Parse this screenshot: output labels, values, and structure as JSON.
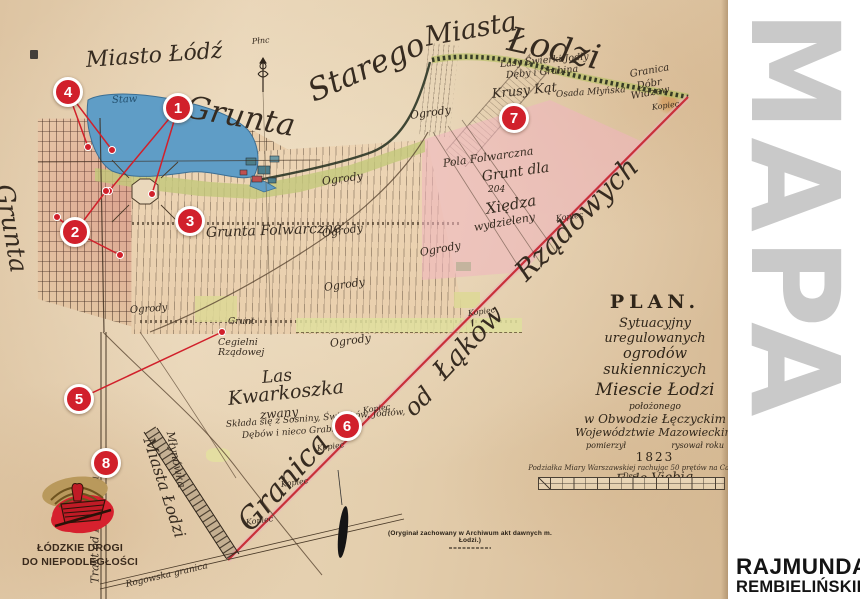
{
  "sidebar": {
    "vertical_title": "MAPA",
    "credit_line1": "RAJMUNDA",
    "credit_line2": "REMBIELIŃSKIEGO"
  },
  "plan_cartouche": {
    "title": "PLAN.",
    "line1": "Sytuacyjny uregulowanych",
    "line2": "ogrodów sukienniczych",
    "line3": "Miescie Łodzi",
    "line4": "położonego",
    "line5": "w Obwodzie Łęczyckim",
    "line6": "Województwie Mazowieckim",
    "measured_label": "pomierzył",
    "drawn_label": "rysował roku",
    "year": "1823",
    "signature": "F. de Viebig"
  },
  "scale": {
    "caption": "Podziałka Miary Warszawskiej rachując 50 prętów na Cal. Dec."
  },
  "source_note": "(Oryginał zachowany w Archiwum akt dawnych m. Łodzi.)",
  "logo": {
    "line1": "ŁÓDZKIE DROGI",
    "line2": "DO NIEPODLEGŁOŚCI"
  },
  "colors": {
    "marker_red": "#d1202b",
    "boundary_red": "#c9303a",
    "water_blue": "#5f9dc6",
    "pink_area": "#f0b5bf",
    "parchment": "#e3cdae",
    "sidebar_gray": "#c9c9c9"
  },
  "markers": [
    {
      "n": "1",
      "x": 178,
      "y": 108,
      "dots": [
        [
          109,
          191
        ],
        [
          152,
          194
        ]
      ]
    },
    {
      "n": "2",
      "x": 75,
      "y": 232,
      "dots": [
        [
          106,
          191
        ],
        [
          57,
          217
        ],
        [
          120,
          255
        ]
      ]
    },
    {
      "n": "3",
      "x": 190,
      "y": 221,
      "dots": []
    },
    {
      "n": "4",
      "x": 68,
      "y": 92,
      "dots": [
        [
          88,
          147
        ],
        [
          112,
          150
        ]
      ]
    },
    {
      "n": "5",
      "x": 79,
      "y": 399,
      "dots": [
        [
          222,
          332
        ]
      ]
    },
    {
      "n": "6",
      "x": 347,
      "y": 426,
      "dots": []
    },
    {
      "n": "7",
      "x": 514,
      "y": 118,
      "dots": []
    },
    {
      "n": "8",
      "x": 106,
      "y": 463,
      "dots": []
    }
  ],
  "labels": [
    {
      "id": "miasto-lodz",
      "t": "Miasto Łódź",
      "x": 86,
      "y": 50,
      "r": -4,
      "s": 22
    },
    {
      "id": "grunta-arc",
      "t": "Grunta",
      "x": 186,
      "y": 92,
      "r": 10,
      "s": 31
    },
    {
      "id": "starego-arc",
      "t": "Starego",
      "x": 310,
      "y": 78,
      "r": -24,
      "s": 31
    },
    {
      "id": "miasta-arc",
      "t": "Miasta",
      "x": 425,
      "y": 24,
      "r": -10,
      "s": 27
    },
    {
      "id": "lodzi-arc",
      "t": "Łodzi",
      "x": 508,
      "y": 22,
      "r": 12,
      "s": 34
    },
    {
      "id": "grunta-west",
      "t": "Grunta",
      "x": 4,
      "y": 172,
      "r": 80,
      "s": 25
    },
    {
      "id": "granica-boundary",
      "t": "Granica",
      "x": 244,
      "y": 512,
      "r": -48,
      "s": 30
    },
    {
      "id": "od-boundary",
      "t": "od",
      "x": 408,
      "y": 400,
      "r": -45,
      "s": 24
    },
    {
      "id": "lakow-boundary",
      "t": "Łąków",
      "x": 438,
      "y": 362,
      "r": -47,
      "s": 27
    },
    {
      "id": "rzadowych-boundary",
      "t": "Rządowych",
      "x": 520,
      "y": 262,
      "r": -45,
      "s": 28
    },
    {
      "id": "las",
      "t": "Las",
      "x": 262,
      "y": 370,
      "r": -5,
      "s": 17
    },
    {
      "id": "kwarkoszka",
      "t": "Kwarkoszka",
      "x": 228,
      "y": 390,
      "r": -6,
      "s": 19
    },
    {
      "id": "zwany",
      "t": "zwany",
      "x": 260,
      "y": 409,
      "r": -5,
      "s": 12
    },
    {
      "id": "las-desc-1",
      "t": "Składa się z Sosniny, Świerków, Jodłów,",
      "x": 226,
      "y": 421,
      "r": -4,
      "s": 9
    },
    {
      "id": "las-desc-2",
      "t": "Dębów i nieco Grabiny",
      "x": 242,
      "y": 432,
      "r": -4,
      "s": 9
    },
    {
      "id": "trakt-piotrkow",
      "t": "Trakt od Piotrkowa",
      "x": 95,
      "y": 578,
      "r": -90,
      "s": 11
    },
    {
      "id": "miasta-lodzi-strip",
      "t": "Miasta Łodzi",
      "x": 148,
      "y": 430,
      "r": 72,
      "s": 16
    },
    {
      "id": "mlynowka",
      "t": "Młynówka",
      "x": 170,
      "y": 426,
      "r": 78,
      "s": 11
    },
    {
      "id": "rogowska",
      "t": "Rogowska granica",
      "x": 126,
      "y": 581,
      "r": -13,
      "s": 9
    },
    {
      "id": "staw",
      "t": "Staw",
      "x": 112,
      "y": 96,
      "r": -3,
      "s": 10,
      "c": "ink-blue"
    },
    {
      "id": "ogrody-1",
      "t": "Ogrody",
      "x": 322,
      "y": 176,
      "r": -8,
      "s": 11
    },
    {
      "id": "ogrody-2",
      "t": "Ogrody",
      "x": 322,
      "y": 228,
      "r": -8,
      "s": 11
    },
    {
      "id": "ogrody-3",
      "t": "Ogrody",
      "x": 324,
      "y": 282,
      "r": -8,
      "s": 11
    },
    {
      "id": "ogrody-4",
      "t": "Ogrody",
      "x": 410,
      "y": 110,
      "r": -8,
      "s": 11
    },
    {
      "id": "ogrody-5",
      "t": "Ogrody",
      "x": 330,
      "y": 338,
      "r": -8,
      "s": 11
    },
    {
      "id": "ogrody-6",
      "t": "Ogrody",
      "x": 130,
      "y": 306,
      "r": -4,
      "s": 10
    },
    {
      "id": "ogrody-7",
      "t": "Ogrody",
      "x": 420,
      "y": 247,
      "r": -10,
      "s": 11
    },
    {
      "id": "grunta-folwarczne",
      "t": "Grunta Folwarczne",
      "x": 206,
      "y": 226,
      "r": -2,
      "s": 14
    },
    {
      "id": "pola-folwarczna",
      "t": "Pola Folwarczna",
      "x": 443,
      "y": 158,
      "r": -8,
      "s": 11
    },
    {
      "id": "grunt-dla",
      "t": "Grunt dla",
      "x": 482,
      "y": 170,
      "r": -8,
      "s": 14
    },
    {
      "id": "num-204",
      "t": "204",
      "x": 488,
      "y": 186,
      "r": 0,
      "s": 9
    },
    {
      "id": "xiedza",
      "t": "Xiędza",
      "x": 486,
      "y": 202,
      "r": -10,
      "s": 15
    },
    {
      "id": "wydzieleny",
      "t": "wydzieleny",
      "x": 474,
      "y": 222,
      "r": -10,
      "s": 11
    },
    {
      "id": "lasy-1",
      "t": "Lasy Świerki Jodły",
      "x": 500,
      "y": 60,
      "r": -5,
      "s": 9.5
    },
    {
      "id": "lasy-2",
      "t": "Dęby i Grabina",
      "x": 506,
      "y": 71,
      "r": -5,
      "s": 9.5
    },
    {
      "id": "krusy-kat",
      "t": "Krusy Kąt",
      "x": 492,
      "y": 88,
      "r": -6,
      "s": 13
    },
    {
      "id": "osada",
      "t": "Osada Młyńska",
      "x": 556,
      "y": 91,
      "r": -4,
      "s": 9
    },
    {
      "id": "granica-dobr-1",
      "t": "Granica",
      "x": 630,
      "y": 70,
      "r": -10,
      "s": 10
    },
    {
      "id": "granica-dobr-2",
      "t": "Dóbr",
      "x": 637,
      "y": 82,
      "r": -10,
      "s": 10
    },
    {
      "id": "granica-dobr-3",
      "t": "Widzew",
      "x": 631,
      "y": 92,
      "r": -10,
      "s": 10
    },
    {
      "id": "cegielni-1",
      "t": "Cegielni",
      "x": 218,
      "y": 338,
      "r": 0,
      "s": 9.5
    },
    {
      "id": "cegielni-2",
      "t": "Rządowej",
      "x": 218,
      "y": 348,
      "r": 0,
      "s": 9.5
    },
    {
      "id": "grunt-small",
      "t": "Grunt",
      "x": 228,
      "y": 318,
      "r": 0,
      "s": 9
    },
    {
      "id": "plnc",
      "t": "Płnc",
      "x": 252,
      "y": 38,
      "r": -5,
      "s": 8
    },
    {
      "id": "kopiec-1",
      "t": "Kopiec",
      "x": 652,
      "y": 104,
      "r": -8,
      "s": 8
    },
    {
      "id": "kopiec-2",
      "t": "Kopiec",
      "x": 556,
      "y": 215,
      "r": -8,
      "s": 8
    },
    {
      "id": "kopiec-3",
      "t": "Kopiec",
      "x": 468,
      "y": 310,
      "r": -8,
      "s": 8
    },
    {
      "id": "kopiec-4",
      "t": "Kopiec",
      "x": 363,
      "y": 407,
      "r": -8,
      "s": 8
    },
    {
      "id": "kopiec-5",
      "t": "Kopiec",
      "x": 317,
      "y": 445,
      "r": -8,
      "s": 8
    },
    {
      "id": "kopiec-6",
      "t": "Kopiec",
      "x": 281,
      "y": 481,
      "r": -8,
      "s": 8
    },
    {
      "id": "kopiec-7",
      "t": "Kopiec",
      "x": 246,
      "y": 519,
      "r": -8,
      "s": 8
    }
  ]
}
